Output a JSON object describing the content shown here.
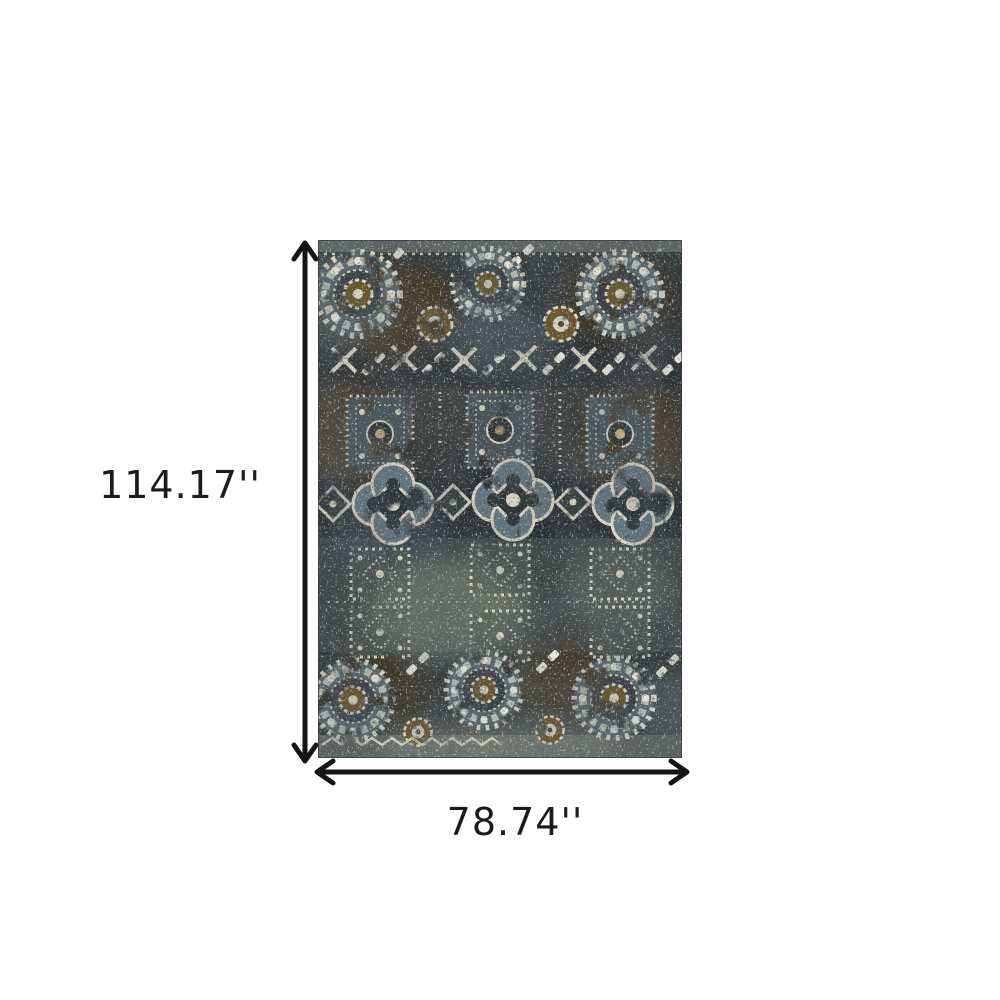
{
  "figure": {
    "type": "product-dimension-diagram",
    "background_color": "#ffffff",
    "arrow_color": "#151515",
    "label_color": "#1b1b1b"
  },
  "dimensions": {
    "height_label": "114.17''",
    "width_label": "78.74''"
  },
  "rug": {
    "style": "distressed-vintage-oriental-medallion",
    "palette": {
      "base_charcoal": "#343a3c",
      "dark": "#22282b",
      "slate_blue": "#5c6d75",
      "gray_green": "#8a9289",
      "brown": "#4e3b21",
      "cream": "#d8d3c3"
    }
  }
}
